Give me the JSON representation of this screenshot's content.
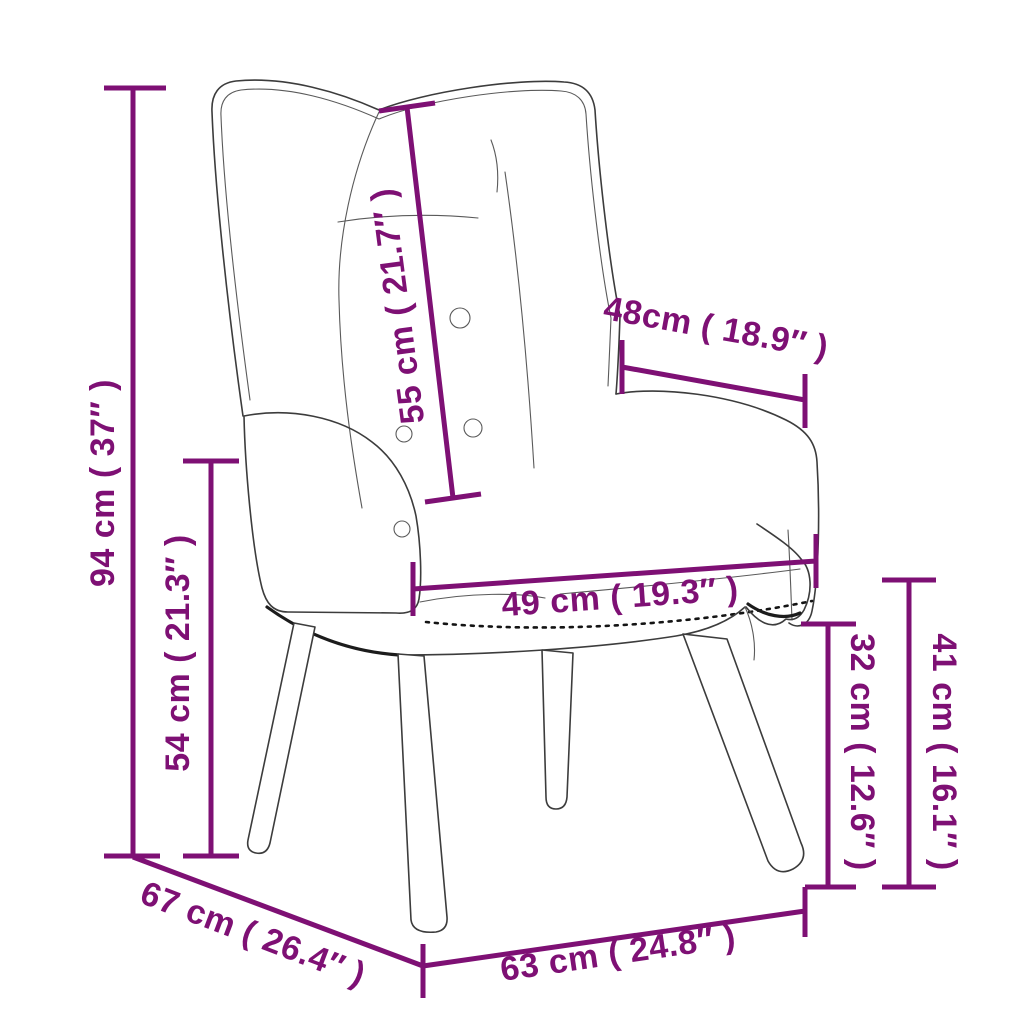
{
  "diagram": {
    "title": "Wingback relax chair with wooden legs — dimension diagram",
    "style": {
      "accent_color": "#7e1074",
      "drawing_color": "#3c3c3c",
      "background": "#ffffff"
    },
    "measurements": {
      "overall_height": {
        "label": "94 cm ( 37″ )",
        "cm": 94,
        "inch": "37″",
        "meaning": "total height, floor to top of backrest"
      },
      "armrest_height": {
        "label": "54 cm ( 21.3″ )",
        "cm": 54,
        "inch": "21.3″",
        "meaning": "floor to armrest top"
      },
      "backrest_length": {
        "label": "55 cm ( 21.7″ )",
        "cm": 55,
        "inch": "21.7″",
        "meaning": "backrest length along the back"
      },
      "upper_width": {
        "label": "48cm ( 18.9″ )",
        "cm": 48,
        "inch": "18.9″",
        "meaning": "width across top of arms"
      },
      "seat_width": {
        "label": "49 cm ( 19.3″ )",
        "cm": 49,
        "inch": "19.3″",
        "meaning": "seat width"
      },
      "seat_height": {
        "label": "32 cm ( 12.6″ )",
        "cm": 32,
        "inch": "12.6″",
        "meaning": "floor to seat underside"
      },
      "front_height": {
        "label": "41 cm ( 16.1″ )",
        "cm": 41,
        "inch": "16.1″",
        "meaning": "floor to seat cushion top"
      },
      "depth": {
        "label": "67 cm ( 26.4″ )",
        "cm": 67,
        "inch": "26.4″",
        "meaning": "overall depth"
      },
      "base_width": {
        "label": "63 cm ( 24.8″ )",
        "cm": 63,
        "inch": "24.8″",
        "meaning": "overall width"
      }
    }
  }
}
